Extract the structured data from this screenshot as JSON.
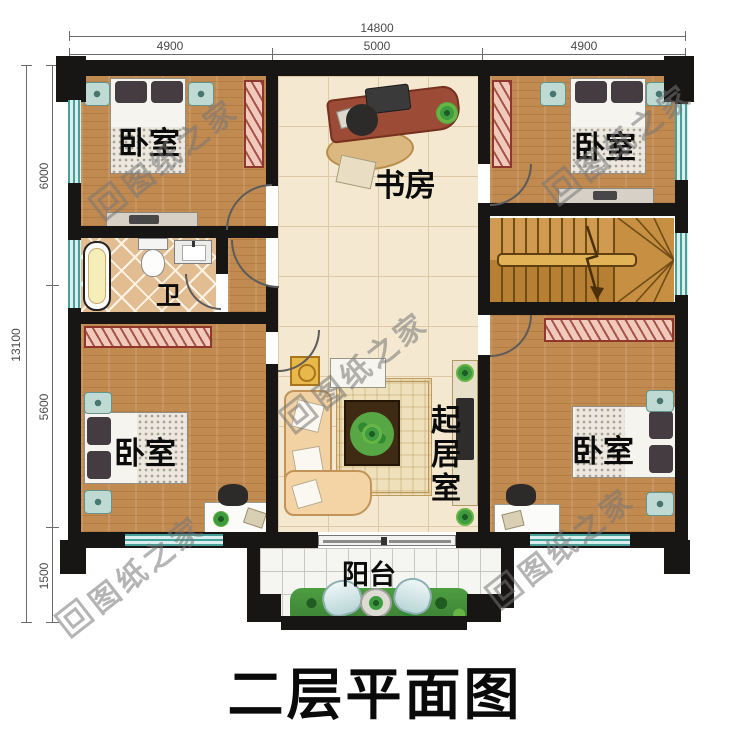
{
  "title": "二层平面图",
  "watermark": {
    "text": "图纸之家"
  },
  "dimensions": {
    "top_total": "14800",
    "top_segments": [
      "4900",
      "5000",
      "4900"
    ],
    "left_total": "13100",
    "left_segments": [
      "6000",
      "5600",
      "1500"
    ]
  },
  "rooms": {
    "bedroom_top_left": "卧室",
    "study": "书房",
    "bedroom_top_right": "卧室",
    "bathroom": "卫",
    "living_room": "起居室",
    "bedroom_bottom_left": "卧室",
    "bedroom_bottom_right": "卧室",
    "balcony": "阳台"
  },
  "colors": {
    "wall": "#171615",
    "wood_floor": "#c18a50",
    "hall_tile": "#f4e9d0",
    "window_teal": "#47a09a",
    "wardrobe_pink": "#f2cabd"
  }
}
